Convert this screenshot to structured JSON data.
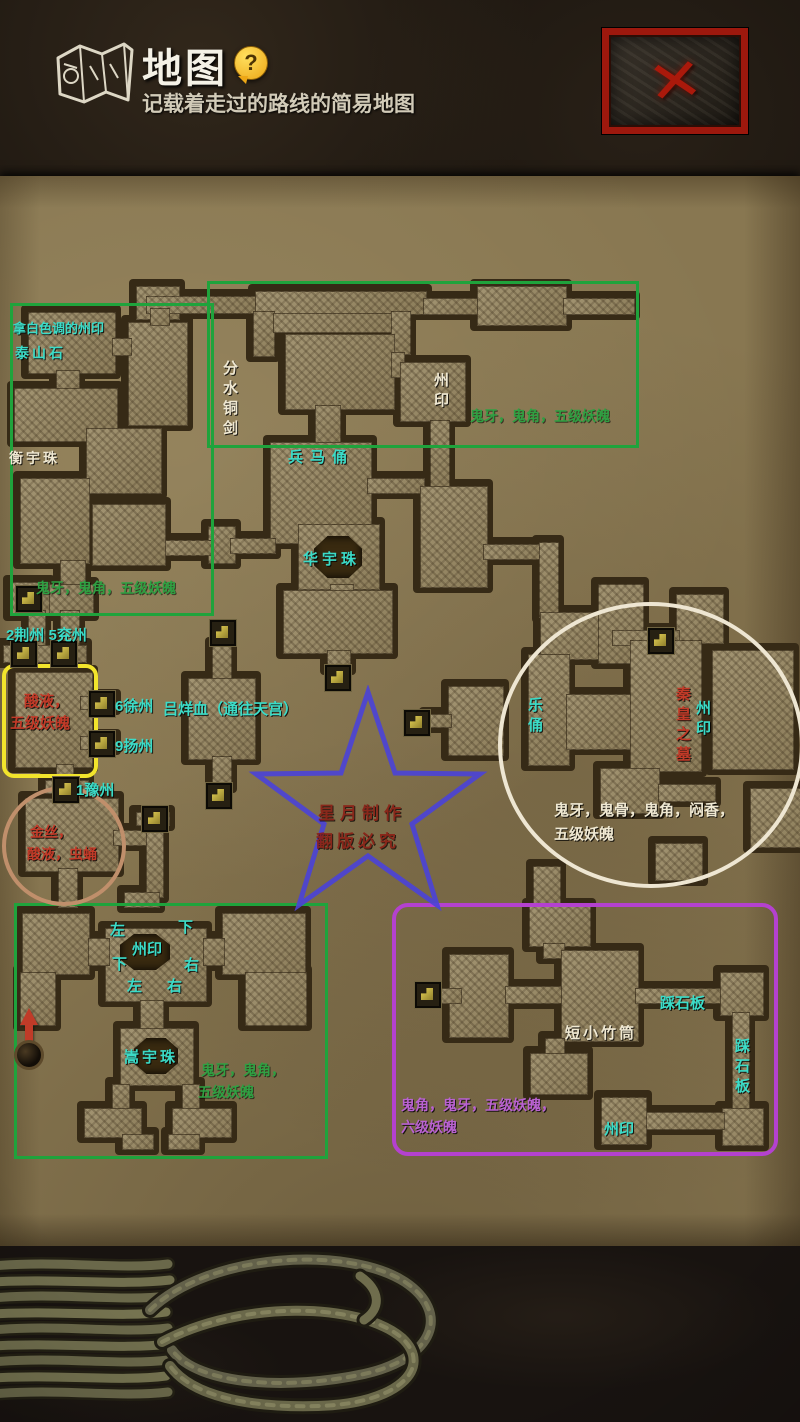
{
  "header": {
    "title": "地图",
    "help_icon": "?",
    "subtitle": "记载着走过的路线的简易地图",
    "close_icon": "✕"
  },
  "map": {
    "labels": {
      "white_seal_hint": "拿白色调的州印",
      "taishan_stone": "泰山石",
      "hengyu_bead": "衡宇珠",
      "fenshui_sword": "分水铜剑",
      "seal_top": "州印",
      "loot_top": "鬼牙，鬼角，五级妖魄",
      "terracotta": "兵马俑",
      "huayu_bead": "华宇珠",
      "loot_left": "鬼牙，鬼角，五级妖魄",
      "states_left": "2荆州 5兖州",
      "acid1": "酸液，",
      "acid2": "五级妖魄",
      "xuzhou": "6徐州",
      "yangzhou": "9扬州",
      "yuzhou": "1豫州",
      "lvyang_blood": "吕烊血（通往天宫）",
      "watermark1": "星月制作",
      "watermark2": "翻版必究",
      "music_figurine": "乐俑",
      "qin_tomb": "秦皇之墓",
      "seal_circle": "州印",
      "loot_circle1": "鬼牙，鬼骨，鬼角，闷香，",
      "loot_circle2": "五级妖魄",
      "goldsilk": "金丝，",
      "acid_pupa": "酸液，虫蛹",
      "dir_left1": "左",
      "dir_down1": "下",
      "seal_bottom": "州印",
      "dir_down2": "下",
      "dir_right1": "右",
      "dir_left2": "左",
      "dir_right2": "右",
      "songyu_bead": "嵩宇珠",
      "loot_bottom1": "鬼牙，鬼角，",
      "loot_bottom2": "五级妖魄",
      "bamboo_tube": "短小竹筒",
      "stone_slab_h": "踩石板",
      "stone_slab_v": "踩石板",
      "seal_purple": "州印",
      "loot_purple1": "鬼角，鬼牙，五级妖魄，",
      "loot_purple2": "六级妖魄"
    }
  },
  "colors": {
    "label_cyan": "#3bdcc8",
    "label_green": "#2fa042",
    "label_red": "#c23a28",
    "label_white": "#efe8d2",
    "label_purple": "#ba62d2",
    "box_green": "#1fa33c",
    "box_yellow": "#f2e42c",
    "box_purple": "#b441cf",
    "circle_white": "#eee6d2",
    "circle_brown": "#c08f6b",
    "star_blue": "#4a43d8",
    "watermark_red": "#8b2016",
    "close_red": "#aa190b",
    "help_yellow": "#eda716"
  }
}
